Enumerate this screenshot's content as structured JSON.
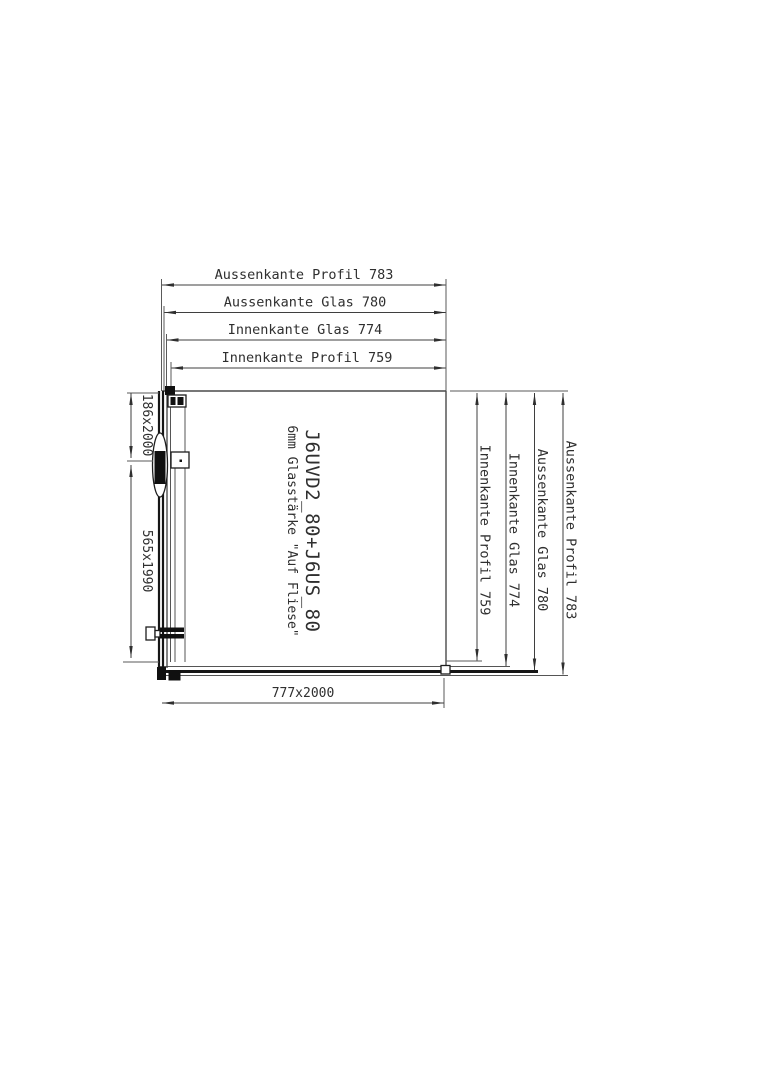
{
  "drawing": {
    "title_block": {
      "product_code": "J6UVD2_80+J6US_80",
      "glass_note": "6mm Glasstärke \"Auf Fliese\""
    },
    "dims_top": [
      {
        "label": "Aussenkante Profil 783"
      },
      {
        "label": "Aussenkante Glas 780"
      },
      {
        "label": "Innenkante Glas 774"
      },
      {
        "label": "Innenkante Profil 759"
      }
    ],
    "dims_right": [
      {
        "label": "Innenkante Profil 759"
      },
      {
        "label": "Innenkante Glas 774"
      },
      {
        "label": "Aussenkante Glas 780"
      },
      {
        "label": "Aussenkante Profil 783"
      }
    ],
    "dims_left": [
      {
        "label": "186x2000"
      },
      {
        "label": "565x1990"
      }
    ],
    "dim_bottom": {
      "label": "777x2000"
    },
    "colors": {
      "background": "#ffffff",
      "line": "#3f3f3f",
      "text": "#2f2f2f",
      "glass": "#161616"
    }
  }
}
